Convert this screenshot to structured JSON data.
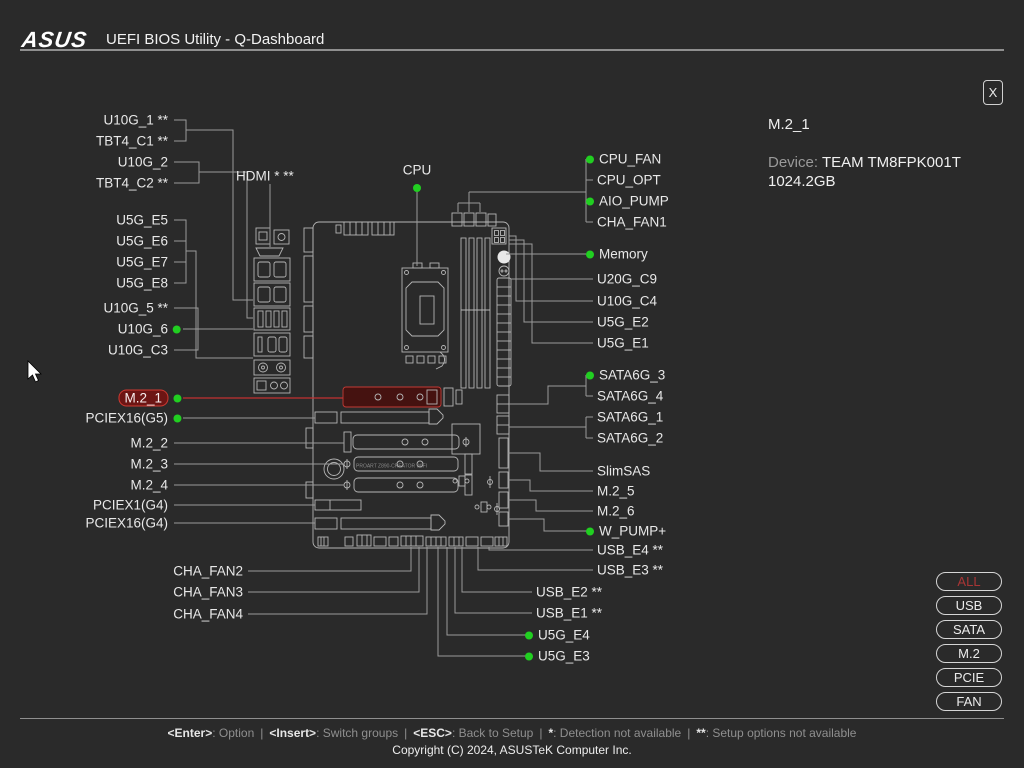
{
  "header": {
    "brand": "ASUS",
    "title": "UEFI BIOS Utility - Q-Dashboard"
  },
  "info_panel": {
    "close_label": "X",
    "selected_item": "M.2_1",
    "device_label": "Device:",
    "device_value": "TEAM TM8FPK001T 1024.2GB"
  },
  "filter_buttons": [
    {
      "label": "ALL",
      "active": true
    },
    {
      "label": "USB",
      "active": false
    },
    {
      "label": "SATA",
      "active": false
    },
    {
      "label": "M.2",
      "active": false
    },
    {
      "label": "PCIE",
      "active": false
    },
    {
      "label": "FAN",
      "active": false
    }
  ],
  "footer": {
    "sep": "|",
    "help": [
      {
        "key": "<Enter>",
        "desc": ": Option"
      },
      {
        "key": "<Insert>",
        "desc": ": Switch groups"
      },
      {
        "key": "<ESC>",
        "desc": ": Back to Setup"
      },
      {
        "key": "*",
        "desc": ": Detection not available"
      },
      {
        "key": "**",
        "desc": ": Setup options not available"
      }
    ],
    "copyright": "Copyright (C) 2024, ASUSTeK Computer Inc."
  },
  "board": {
    "model_text": "PROART Z890-CREATOR WIFI"
  },
  "colors": {
    "background": "#2a2a2a",
    "green_dot": "#21cf21",
    "line_gray": "#9a9a9a",
    "accent_red": "#c23232",
    "selected_fill": "#6d1514"
  },
  "diagram": {
    "labels": [
      {
        "t": "U10G_1 **",
        "x": 168,
        "y": 120,
        "a": "end"
      },
      {
        "t": "TBT4_C1 **",
        "x": 168,
        "y": 141,
        "a": "end"
      },
      {
        "t": "U10G_2",
        "x": 168,
        "y": 162,
        "a": "end"
      },
      {
        "t": "TBT4_C2 **",
        "x": 168,
        "y": 183,
        "a": "end"
      },
      {
        "t": "U5G_E5",
        "x": 168,
        "y": 220,
        "a": "end"
      },
      {
        "t": "U5G_E6",
        "x": 168,
        "y": 241,
        "a": "end"
      },
      {
        "t": "U5G_E7",
        "x": 168,
        "y": 262,
        "a": "end"
      },
      {
        "t": "U5G_E8",
        "x": 168,
        "y": 283,
        "a": "end"
      },
      {
        "t": "U10G_5 **",
        "x": 168,
        "y": 308,
        "a": "end"
      },
      {
        "t": "U10G_6",
        "x": 181,
        "y": 329,
        "a": "end",
        "dot": "after"
      },
      {
        "t": "U10G_C3",
        "x": 168,
        "y": 350,
        "a": "end"
      },
      {
        "t": "M.2_1",
        "x": 181,
        "y": 398,
        "a": "end",
        "dot": "after",
        "selected": true
      },
      {
        "t": "PCIEX16(G5)",
        "x": 181,
        "y": 418,
        "a": "end",
        "dot": "after"
      },
      {
        "t": "M.2_2",
        "x": 168,
        "y": 443,
        "a": "end"
      },
      {
        "t": "M.2_3",
        "x": 168,
        "y": 464,
        "a": "end"
      },
      {
        "t": "M.2_4",
        "x": 168,
        "y": 485,
        "a": "end"
      },
      {
        "t": "PCIEX1(G4)",
        "x": 168,
        "y": 505,
        "a": "end"
      },
      {
        "t": "PCIEX16(G4)",
        "x": 168,
        "y": 523,
        "a": "end"
      },
      {
        "t": "CHA_FAN2",
        "x": 243,
        "y": 571,
        "a": "end"
      },
      {
        "t": "CHA_FAN3",
        "x": 243,
        "y": 592,
        "a": "end"
      },
      {
        "t": "CHA_FAN4",
        "x": 243,
        "y": 614,
        "a": "end"
      },
      {
        "t": "HDMI * **",
        "x": 236,
        "y": 176,
        "a": "start"
      },
      {
        "t": "CPU",
        "x": 417,
        "y": 170,
        "a": "middle"
      },
      {
        "t": "CPU_FAN",
        "x": 586,
        "y": 159,
        "a": "start",
        "dot": "before"
      },
      {
        "t": "CPU_OPT",
        "x": 597,
        "y": 180,
        "a": "start"
      },
      {
        "t": "AIO_PUMP",
        "x": 586,
        "y": 201,
        "a": "start",
        "dot": "before"
      },
      {
        "t": "CHA_FAN1",
        "x": 597,
        "y": 222,
        "a": "start"
      },
      {
        "t": "Memory",
        "x": 586,
        "y": 254,
        "a": "start",
        "dot": "before"
      },
      {
        "t": "U20G_C9",
        "x": 597,
        "y": 279,
        "a": "start"
      },
      {
        "t": "U10G_C4",
        "x": 597,
        "y": 301,
        "a": "start"
      },
      {
        "t": "U5G_E2",
        "x": 597,
        "y": 322,
        "a": "start"
      },
      {
        "t": "U5G_E1",
        "x": 597,
        "y": 343,
        "a": "start"
      },
      {
        "t": "SATA6G_3",
        "x": 586,
        "y": 375,
        "a": "start",
        "dot": "before"
      },
      {
        "t": "SATA6G_4",
        "x": 597,
        "y": 396,
        "a": "start"
      },
      {
        "t": "SATA6G_1",
        "x": 597,
        "y": 417,
        "a": "start"
      },
      {
        "t": "SATA6G_2",
        "x": 597,
        "y": 438,
        "a": "start"
      },
      {
        "t": "SlimSAS",
        "x": 597,
        "y": 471,
        "a": "start"
      },
      {
        "t": "M.2_5",
        "x": 597,
        "y": 491,
        "a": "start"
      },
      {
        "t": "M.2_6",
        "x": 597,
        "y": 511,
        "a": "start"
      },
      {
        "t": "W_PUMP+",
        "x": 586,
        "y": 531,
        "a": "start",
        "dot": "before"
      },
      {
        "t": "USB_E4 **",
        "x": 597,
        "y": 550,
        "a": "start"
      },
      {
        "t": "USB_E3 **",
        "x": 597,
        "y": 570,
        "a": "start"
      },
      {
        "t": "USB_E2 **",
        "x": 536,
        "y": 592,
        "a": "start"
      },
      {
        "t": "USB_E1 **",
        "x": 536,
        "y": 613,
        "a": "start"
      },
      {
        "t": "U5G_E4",
        "x": 525,
        "y": 635,
        "a": "start",
        "dot": "before"
      },
      {
        "t": "U5G_E3",
        "x": 525,
        "y": 656,
        "a": "start",
        "dot": "before"
      }
    ],
    "lines": [
      {
        "p": [
          174,
          120,
          186,
          120,
          186,
          141,
          174,
          141
        ]
      },
      {
        "p": [
          186,
          130,
          233,
          130,
          233,
          300,
          253,
          300
        ]
      },
      {
        "p": [
          174,
          162,
          199,
          162,
          199,
          183,
          174,
          183
        ]
      },
      {
        "p": [
          199,
          172,
          247,
          172,
          247,
          318,
          253,
          318
        ]
      },
      {
        "p": [
          174,
          220,
          186,
          220,
          186,
          283,
          174,
          283
        ]
      },
      {
        "p": [
          174,
          241,
          186,
          241
        ]
      },
      {
        "p": [
          174,
          262,
          186,
          262
        ]
      },
      {
        "p": [
          186,
          251,
          196,
          251,
          196,
          358,
          253,
          358
        ]
      },
      {
        "p": [
          174,
          308,
          198,
          308,
          198,
          350,
          174,
          350
        ]
      },
      {
        "p": [
          183,
          329,
          198,
          329
        ]
      },
      {
        "p": [
          198,
          329,
          253,
          329
        ]
      },
      {
        "p": [
          270,
          184,
          270,
          247
        ]
      },
      {
        "p": [
          417,
          192,
          417,
          266
        ]
      },
      {
        "p": [
          183,
          398,
          343,
          398
        ],
        "c": "red"
      },
      {
        "p": [
          183,
          418,
          315,
          418
        ]
      },
      {
        "p": [
          174,
          443,
          344,
          443
        ]
      },
      {
        "p": [
          174,
          464,
          344,
          464
        ]
      },
      {
        "p": [
          174,
          485,
          344,
          485
        ]
      },
      {
        "p": [
          174,
          505,
          315,
          505
        ]
      },
      {
        "p": [
          174,
          523,
          315,
          523
        ]
      },
      {
        "p": [
          248,
          571,
          411,
          571,
          411,
          547
        ]
      },
      {
        "p": [
          248,
          592,
          419,
          592,
          419,
          547
        ]
      },
      {
        "p": [
          248,
          614,
          427,
          614,
          427,
          547
        ]
      },
      {
        "p": [
          458,
          212,
          458,
          203
        ]
      },
      {
        "p": [
          469,
          212,
          469,
          203
        ]
      },
      {
        "p": [
          480,
          212,
          480,
          203
        ]
      },
      {
        "p": [
          458,
          203,
          480,
          203
        ]
      },
      {
        "p": [
          469,
          203,
          469,
          192
        ]
      },
      {
        "p": [
          469,
          192,
          586,
          192
        ]
      },
      {
        "p": [
          586,
          159,
          586,
          222
        ]
      },
      {
        "p": [
          586,
          159,
          592,
          159
        ]
      },
      {
        "p": [
          586,
          180,
          593,
          180
        ]
      },
      {
        "p": [
          586,
          201,
          592,
          201
        ]
      },
      {
        "p": [
          586,
          222,
          593,
          222
        ]
      },
      {
        "p": [
          506,
          254,
          586,
          254
        ]
      },
      {
        "p": [
          511,
          279,
          593,
          279
        ]
      },
      {
        "p": [
          509,
          236,
          516,
          236,
          516,
          301,
          593,
          301
        ]
      },
      {
        "p": [
          509,
          240,
          524,
          240,
          524,
          322,
          593,
          322
        ]
      },
      {
        "p": [
          509,
          244,
          532,
          244,
          532,
          343,
          593,
          343
        ]
      },
      {
        "p": [
          509,
          404,
          548,
          404,
          548,
          386,
          586,
          386
        ]
      },
      {
        "p": [
          586,
          375,
          586,
          396
        ]
      },
      {
        "p": [
          586,
          375,
          592,
          375
        ]
      },
      {
        "p": [
          586,
          396,
          593,
          396
        ]
      },
      {
        "p": [
          509,
          427,
          556,
          427,
          586,
          427
        ]
      },
      {
        "p": [
          586,
          417,
          586,
          438
        ]
      },
      {
        "p": [
          586,
          417,
          593,
          417
        ]
      },
      {
        "p": [
          586,
          438,
          593,
          438
        ]
      },
      {
        "p": [
          508,
          453,
          540,
          453,
          540,
          471,
          593,
          471
        ]
      },
      {
        "p": [
          508,
          480,
          530,
          480,
          530,
          491,
          593,
          491
        ]
      },
      {
        "p": [
          508,
          500,
          536,
          500,
          536,
          511,
          593,
          511
        ]
      },
      {
        "p": [
          508,
          519,
          544,
          519,
          544,
          531,
          592,
          531
        ]
      },
      {
        "p": [
          489,
          547,
          489,
          550,
          593,
          550
        ]
      },
      {
        "p": [
          478,
          547,
          478,
          570,
          593,
          570
        ]
      },
      {
        "p": [
          462,
          547,
          462,
          592,
          532,
          592
        ]
      },
      {
        "p": [
          455,
          547,
          455,
          613,
          532,
          613
        ]
      },
      {
        "p": [
          447,
          547,
          447,
          635,
          531,
          635
        ]
      },
      {
        "p": [
          438,
          547,
          438,
          656,
          531,
          656
        ]
      }
    ],
    "dots": [
      {
        "x": 417,
        "y": 188
      }
    ]
  }
}
